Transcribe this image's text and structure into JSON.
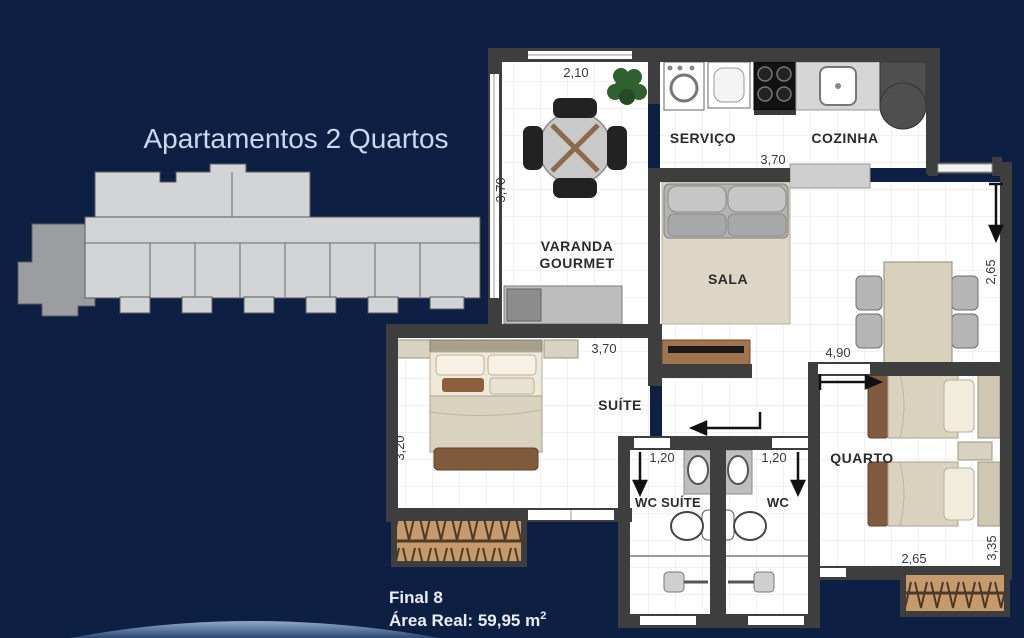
{
  "header": {
    "title": "Apartamentos 2 Quartos"
  },
  "footer": {
    "unit": "Final 8",
    "area": "Área Real: 59,95 m",
    "area_sup": "2"
  },
  "rooms": {
    "varanda_line1": "VARANDA",
    "varanda_line2": "GOURMET",
    "servico": "SERVIÇO",
    "cozinha": "COZINHA",
    "sala": "SALA",
    "suite": "SUÍTE",
    "wc_suite": "WC SUÍTE",
    "wc": "WC",
    "quarto": "QUARTO"
  },
  "dimensions": {
    "varanda_width": "2,10",
    "varanda_depth": "3,70",
    "cozinha_width": "3,70",
    "dining_depth": "2,65",
    "dining_width": "4,90",
    "suite_width": "3,70",
    "suite_depth": "3,20",
    "wc_suite_width": "1,20",
    "wc_width": "1,20",
    "quarto_width": "2,65",
    "quarto_depth": "3,35"
  },
  "colors": {
    "background": "#0d2044",
    "wall": "#3e3e3e",
    "title_text": "#c9d8ee",
    "footer_text": "#e9eef6",
    "plan_floor": "#ffffff",
    "grid_line": "#e3e3e3",
    "keyplan_light": "#d3d4d6",
    "keyplan_dark": "#9b9da0",
    "hatch_fill": "#c59b6b",
    "furniture_beige": "#d9d2bf",
    "furniture_brown": "#7f5a3c",
    "sofa_grey": "#b3b3b3"
  }
}
